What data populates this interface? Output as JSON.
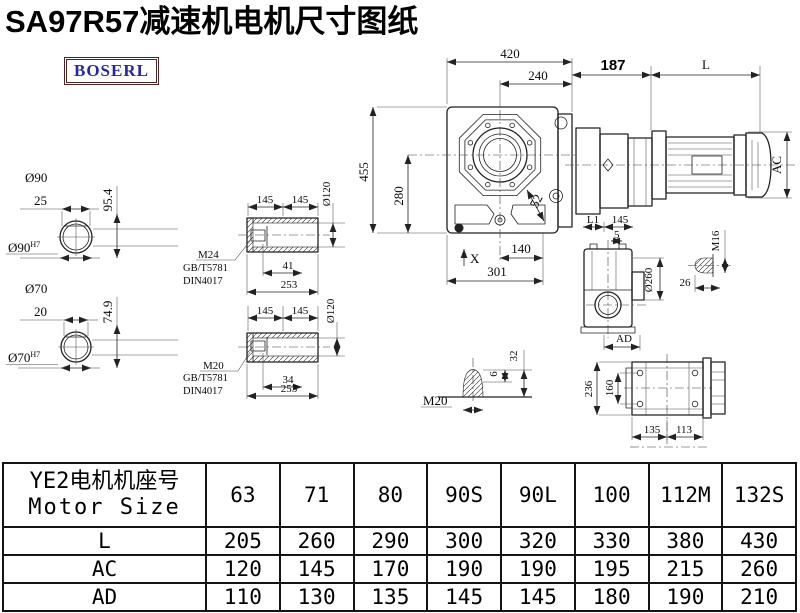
{
  "title": "SA97R57减速机电机尺寸图纸",
  "logo": {
    "text": "BOSERL"
  },
  "drawing": {
    "shaft_section_90": {
      "dia": "Ø90",
      "len": "25",
      "height": "95.4",
      "fit": "Ø90",
      "fit_sup": "H7"
    },
    "shaft_section_70": {
      "dia": "Ø70",
      "len": "20",
      "height": "74.9",
      "fit": "Ø70",
      "fit_sup": "H7"
    },
    "sleeve_top": {
      "half1": "145",
      "half2": "145",
      "bore": "Ø120",
      "thread": "M24",
      "std1": "GB/T5781",
      "std2": "DIN4017",
      "len1": "41",
      "len2": "253"
    },
    "sleeve_bottom": {
      "half1": "145",
      "half2": "145",
      "bore": "Ø120",
      "thread": "M20",
      "std1": "GB/T5781",
      "std2": "DIN4017",
      "len1": "34",
      "len2": "253"
    },
    "front_view": {
      "width": "420",
      "width2": "240",
      "height": "455",
      "height2": "280",
      "d52": "52",
      "d140": "140",
      "d301": "301",
      "x_mark": "X"
    },
    "motor_view": {
      "d187": "187",
      "L": "L",
      "AC": "AC"
    },
    "side_view": {
      "L1": "L1",
      "d145": "145",
      "d5": "5",
      "dia": "Ø260",
      "AD": "AD"
    },
    "bolt_m16": {
      "thread": "M16",
      "len": "26"
    },
    "bolt_m20": {
      "thread": "M20",
      "d6": "6",
      "d32": "32"
    },
    "top_view": {
      "d236": "236",
      "d160": "160",
      "d135": "135",
      "d113": "113"
    }
  },
  "table": {
    "header_cn": "YE2电机机座号",
    "header_en": "Motor Size",
    "columns": [
      "63",
      "71",
      "80",
      "90S",
      "90L",
      "100",
      "112M",
      "132S"
    ],
    "rows": [
      {
        "label": "L",
        "values": [
          "205",
          "260",
          "290",
          "300",
          "320",
          "330",
          "380",
          "430"
        ]
      },
      {
        "label": "AC",
        "values": [
          "120",
          "145",
          "170",
          "190",
          "190",
          "195",
          "215",
          "260"
        ]
      },
      {
        "label": "AD",
        "values": [
          "110",
          "130",
          "135",
          "145",
          "145",
          "180",
          "190",
          "210"
        ]
      }
    ]
  }
}
